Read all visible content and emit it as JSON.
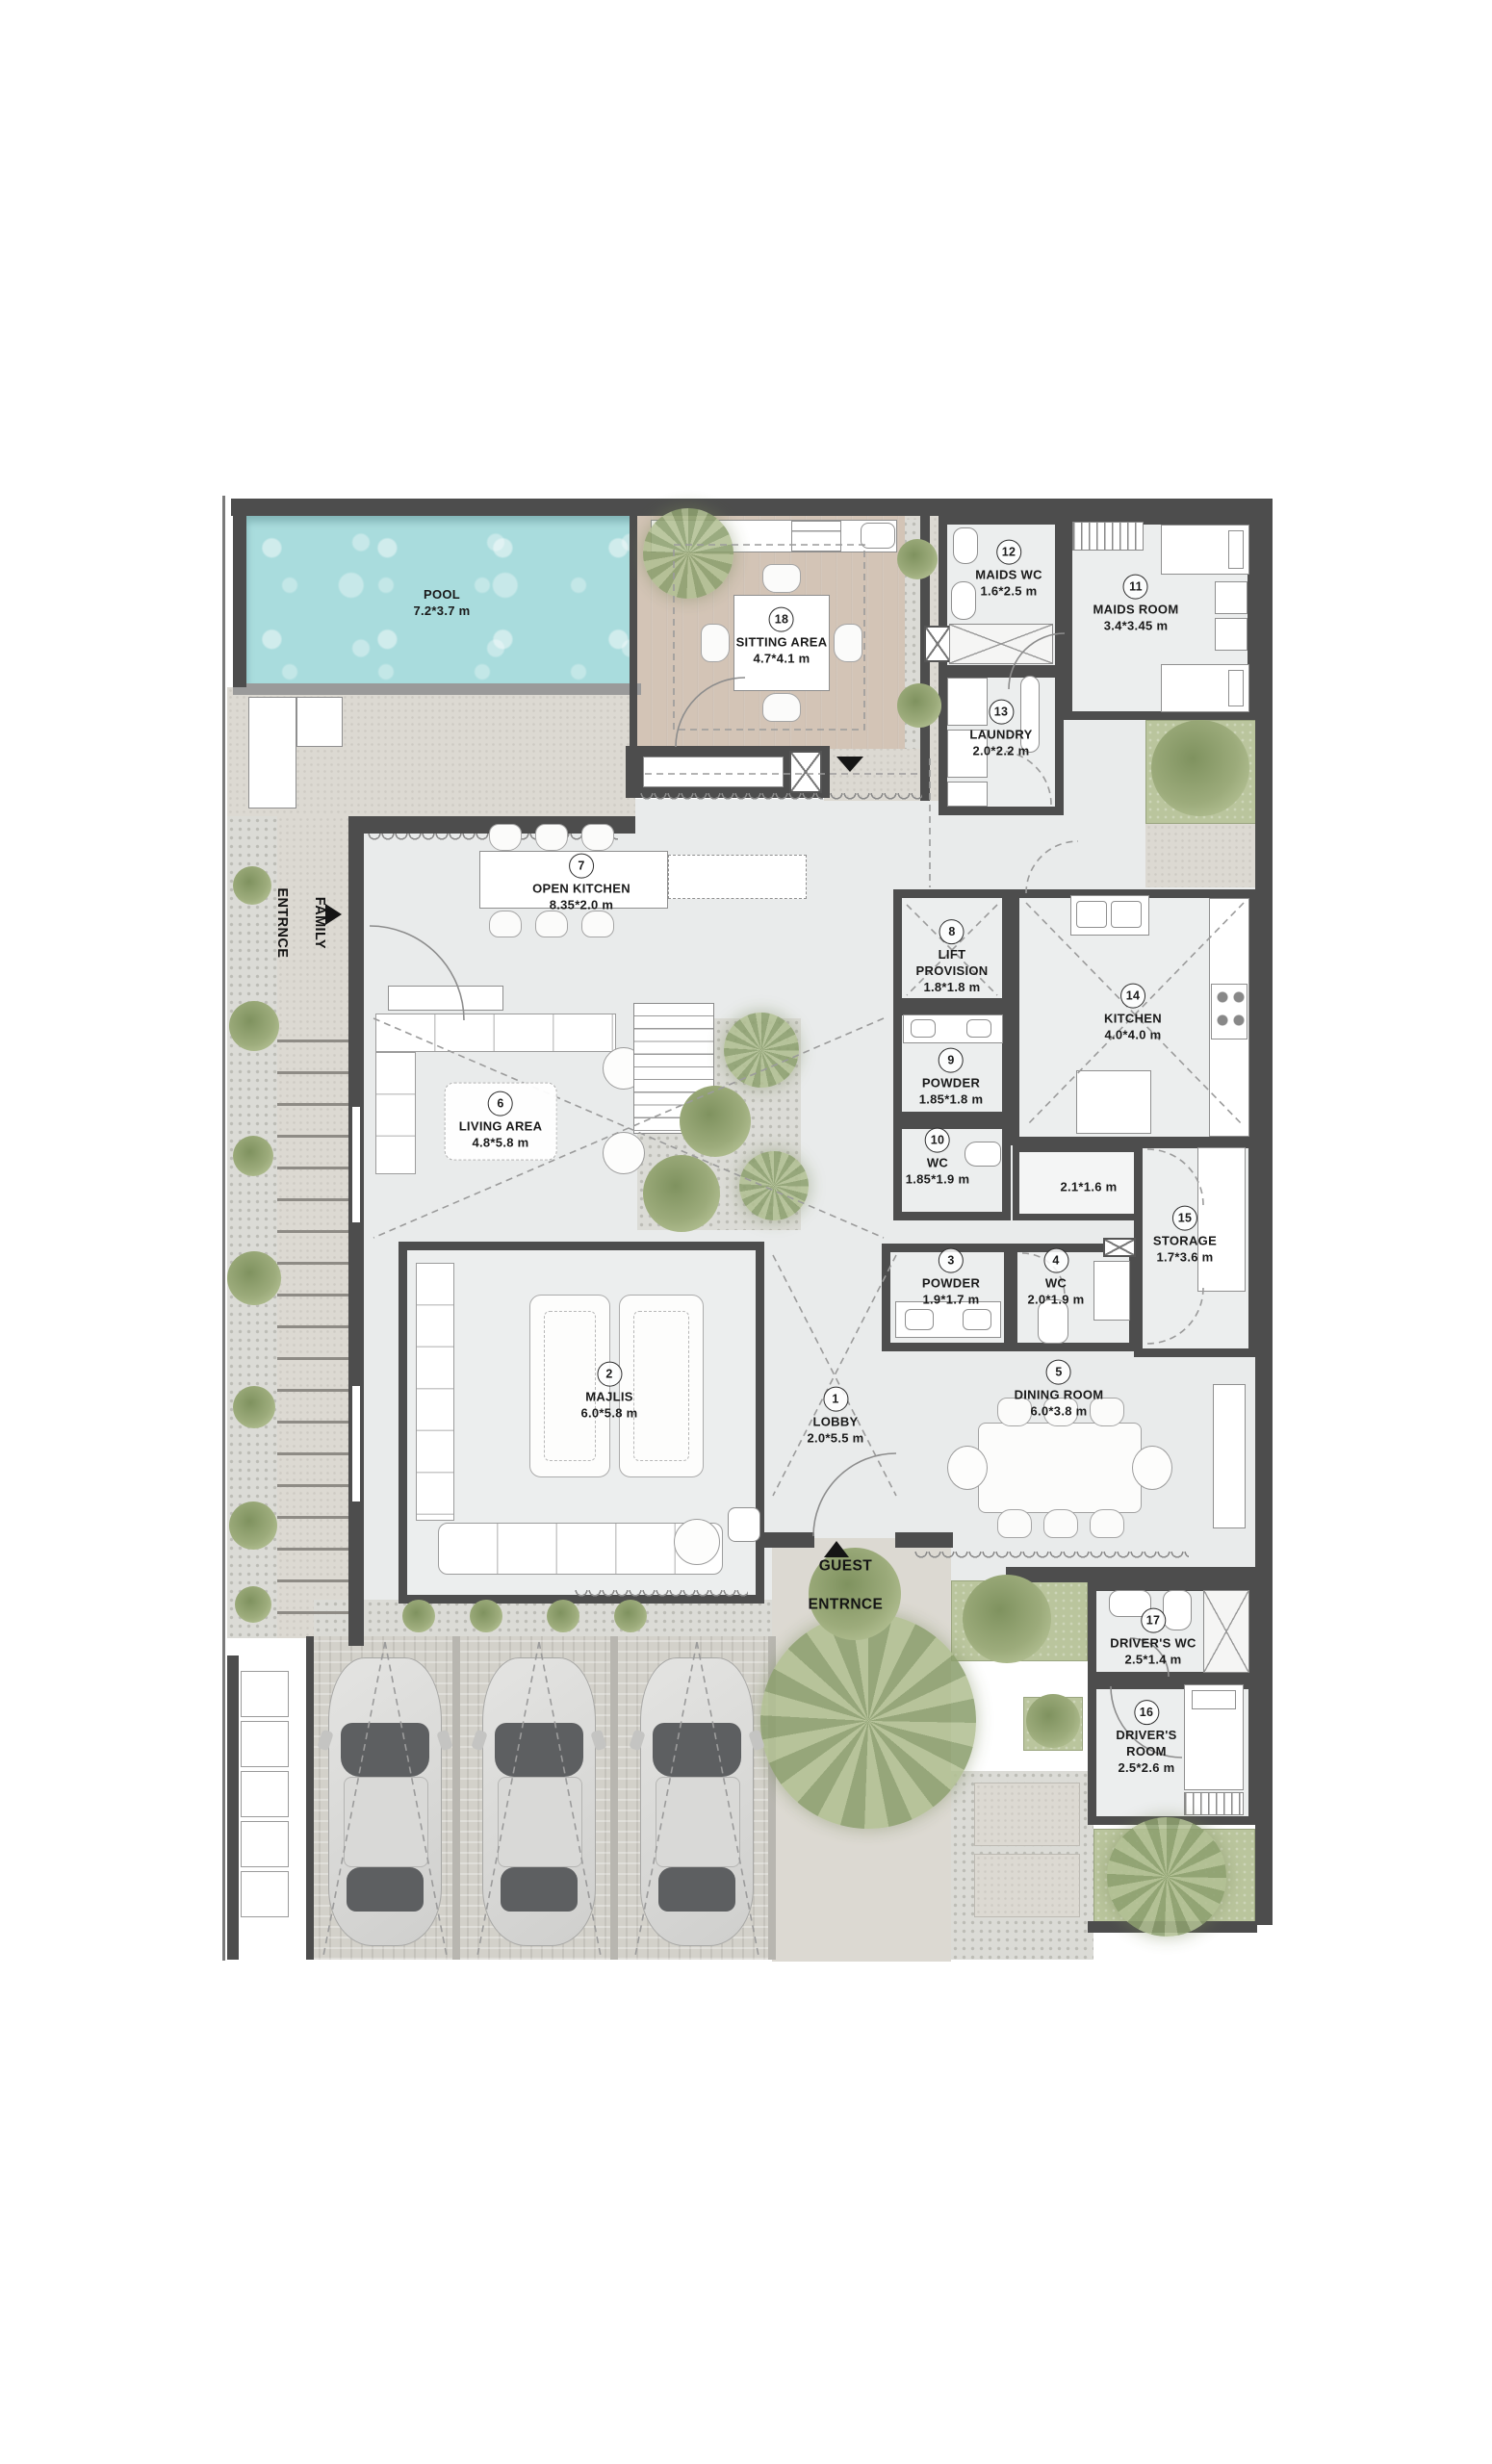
{
  "plan": {
    "rooms": [
      {
        "id": "lobby",
        "num": "1",
        "name": "LOBBY",
        "dims": "2.0*5.5 m"
      },
      {
        "id": "majlis",
        "num": "2",
        "name": "MAJLIS",
        "dims": "6.0*5.8 m"
      },
      {
        "id": "powder-3",
        "num": "3",
        "name": "POWDER",
        "dims": "1.9*1.7 m"
      },
      {
        "id": "wc-4",
        "num": "4",
        "name": "WC",
        "dims": "2.0*1.9 m"
      },
      {
        "id": "dining-room",
        "num": "5",
        "name": "DINING ROOM",
        "dims": "6.0*3.8 m"
      },
      {
        "id": "living-area",
        "num": "6",
        "name": "LIVING AREA",
        "dims": "4.8*5.8 m"
      },
      {
        "id": "open-kitchen",
        "num": "7",
        "name": "OPEN KITCHEN",
        "dims": "8.35*2.0 m"
      },
      {
        "id": "lift-provision",
        "num": "8",
        "name": "LIFT\nPROVISION",
        "dims": "1.8*1.8 m"
      },
      {
        "id": "powder-9",
        "num": "9",
        "name": "POWDER",
        "dims": "1.85*1.8 m"
      },
      {
        "id": "wc-10",
        "num": "10",
        "name": "WC",
        "dims": "1.85*1.9 m"
      },
      {
        "id": "maids-room",
        "num": "11",
        "name": "MAIDS ROOM",
        "dims": "3.4*3.45 m"
      },
      {
        "id": "maids-wc",
        "num": "12",
        "name": "MAIDS WC",
        "dims": "1.6*2.5 m"
      },
      {
        "id": "laundry",
        "num": "13",
        "name": "LAUNDRY",
        "dims": "2.0*2.2 m"
      },
      {
        "id": "kitchen",
        "num": "14",
        "name": "KITCHEN",
        "dims": "4.0*4.0 m"
      },
      {
        "id": "storage",
        "num": "15",
        "name": "STORAGE",
        "dims": "1.7*3.6 m"
      },
      {
        "id": "drivers-room",
        "num": "16",
        "name": "DRIVER'S\nROOM",
        "dims": "2.5*2.6 m"
      },
      {
        "id": "drivers-wc",
        "num": "17",
        "name": "DRIVER'S WC",
        "dims": "2.5*1.4 m"
      },
      {
        "id": "sitting-area",
        "num": "18",
        "name": "SITTING AREA",
        "dims": "4.7*4.1 m"
      },
      {
        "id": "pool",
        "num": "",
        "name": "POOL",
        "dims": "7.2*3.7 m"
      },
      {
        "id": "kitchen-yard",
        "num": "",
        "name": "",
        "dims": "2.1*1.6 m"
      }
    ],
    "entrances": {
      "family": {
        "line1": "FAMILY",
        "line2": "ENTRNCE"
      },
      "guest": {
        "line1": "GUEST",
        "line2": "ENTRNCE"
      }
    },
    "colors": {
      "wall": "#4d4d4d",
      "pool": "#a9dcdd",
      "wood": "#d3c4b6",
      "floor": "#e9ebeb",
      "paving": "#dcd9d2",
      "green": "#bac59d",
      "accent_text": "#1a1a1a"
    }
  }
}
